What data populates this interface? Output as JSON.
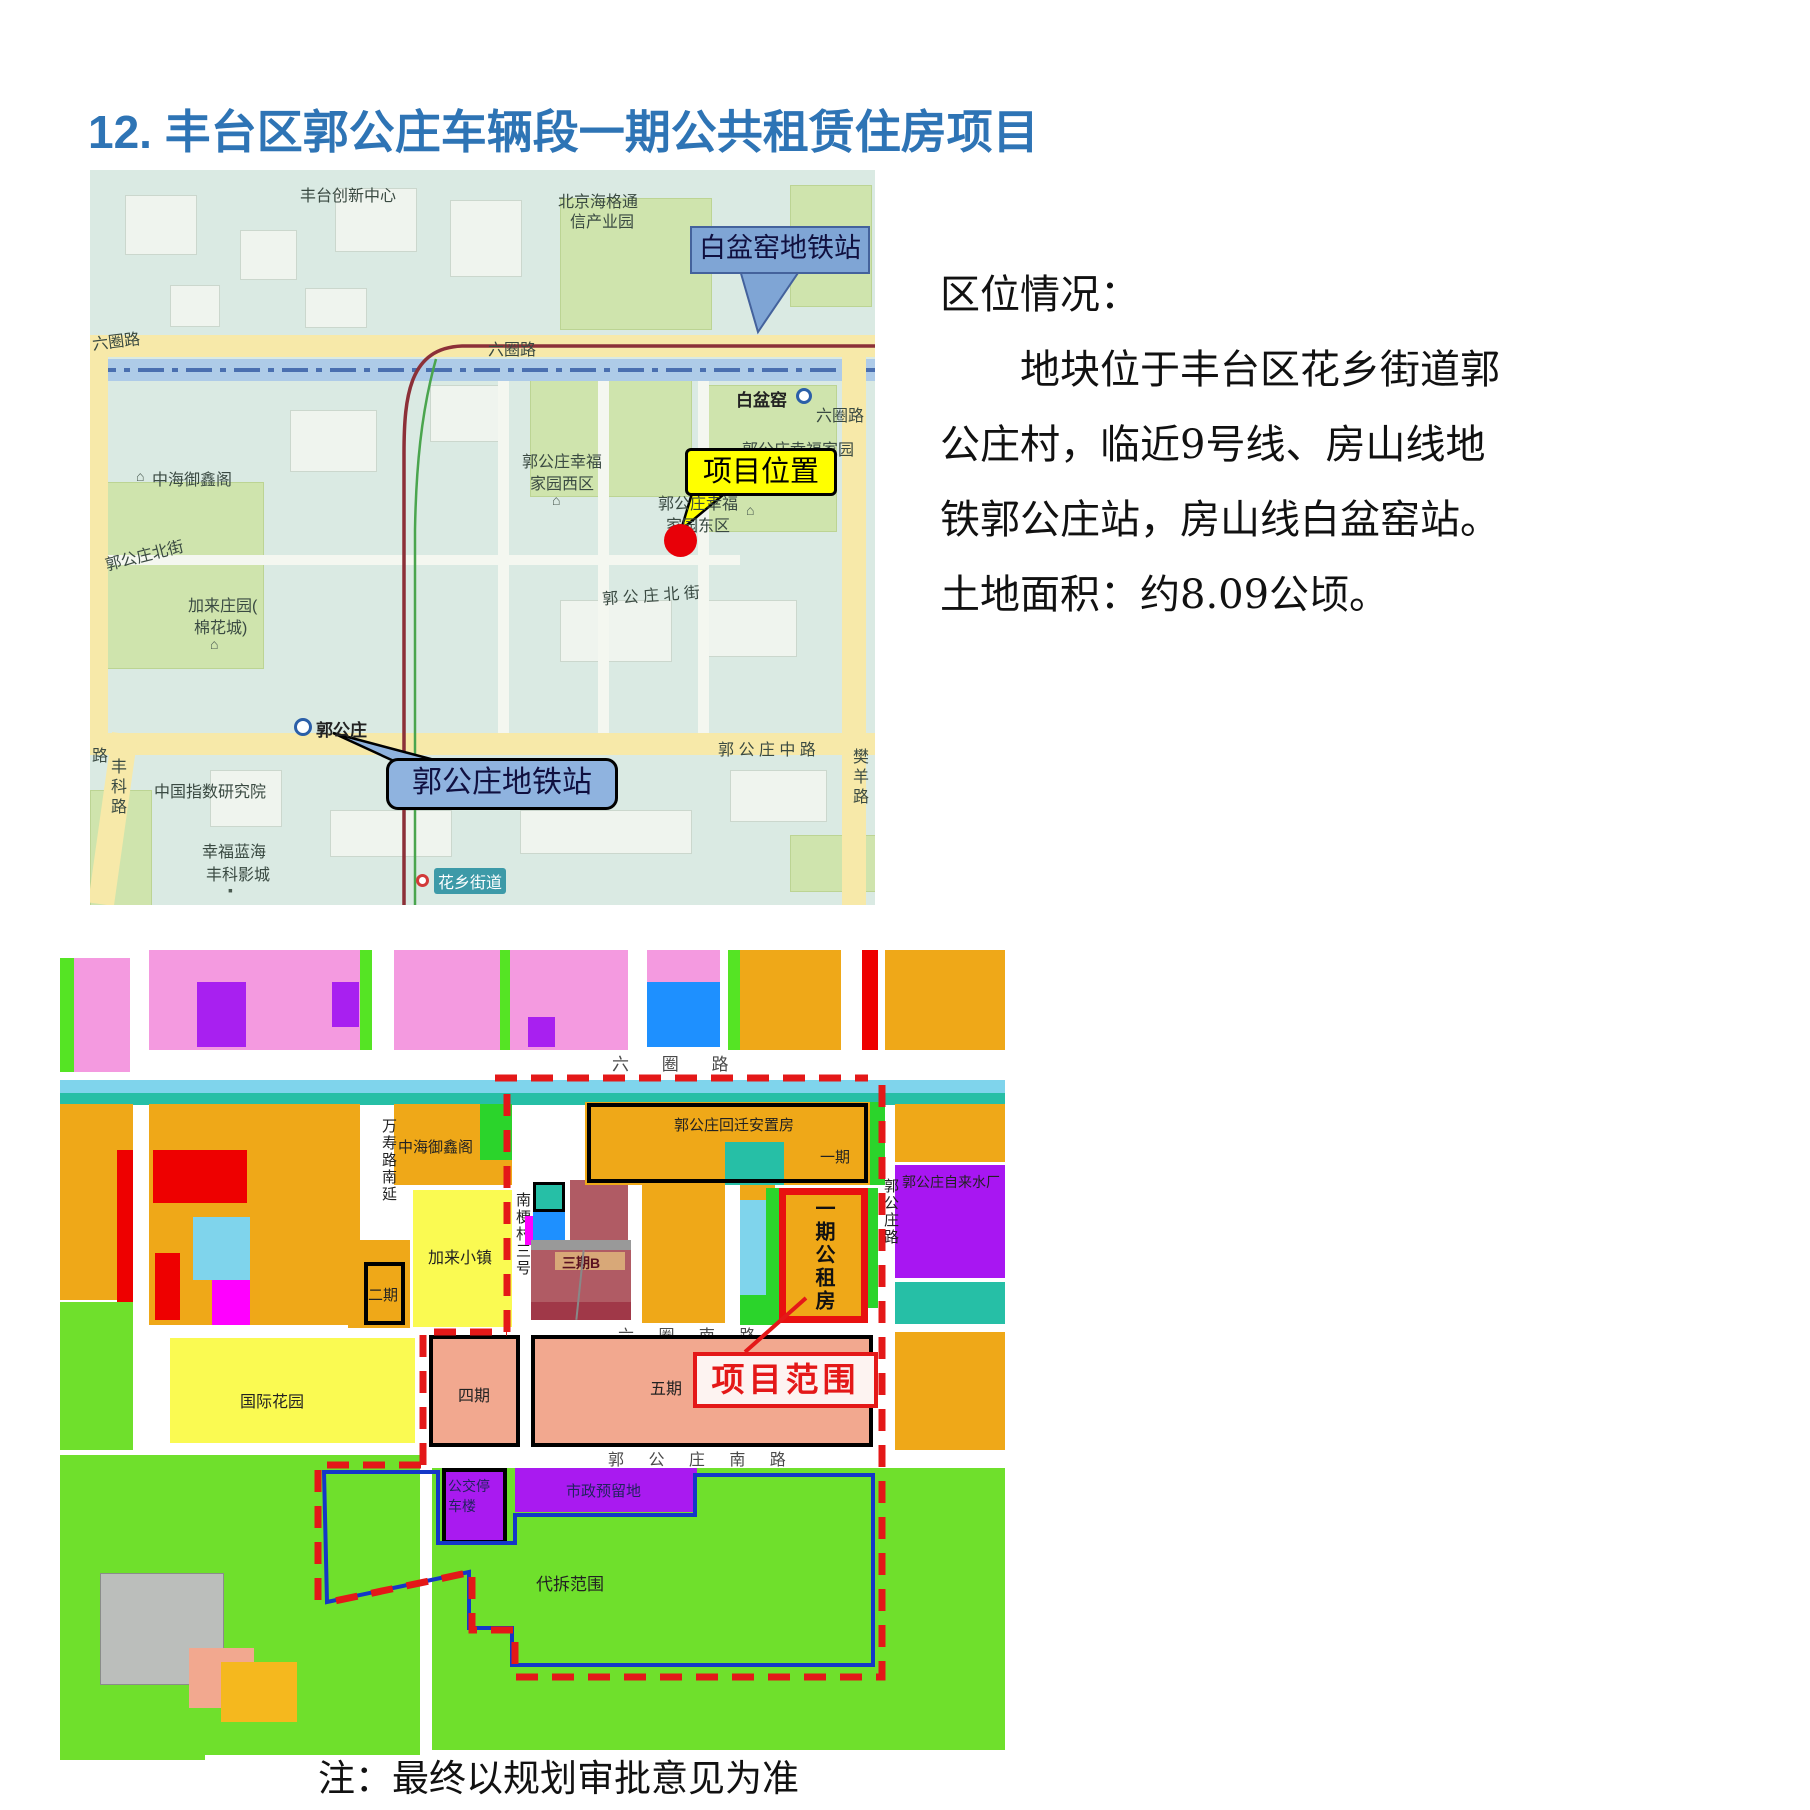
{
  "page": {
    "title": "12. 丰台区郭公庄车辆段一期公共租赁住房项目",
    "note": "注：最终以规划审批意见为准"
  },
  "info": {
    "heading": "区位情况：",
    "lines": [
      "地块位于丰台区花乡街道郭",
      "公庄村，临近9号线、房山线地",
      "铁郭公庄站，房山线白盆窑站。",
      "土地面积：约8.09公顷。"
    ]
  },
  "colors": {
    "title_blue": "#2E74B5",
    "callout_yellow": "#FFFF00",
    "callout_blue": "#7FA5D5",
    "boundary_red": "#E41818",
    "boundary_blue": "#1437C8",
    "marker_red": "#E80008"
  },
  "street_map": {
    "callouts": {
      "baipenyao": "白盆窑地铁站",
      "project_location": "项目位置",
      "guogongzhuang": "郭公庄地铁站"
    },
    "stations": {
      "baipenyao": "白盆窑",
      "guogongzhuang": "郭公庄"
    },
    "roads": {
      "liuquan_left": "六圈路",
      "liuquan_mid": "六圈路",
      "liuquan_right": "六圈路",
      "ggz_north_west": "郭公庄北街",
      "ggz_north_east": "郭 公 庄 北 街",
      "ggz_middle": "郭 公 庄 中 路",
      "fengke": "丰科路",
      "fanyang": "樊羊路",
      "lu": "路"
    },
    "places": {
      "fengtai_innovation": "丰台创新中心",
      "haige_1": "北京海格通",
      "haige_2": "信产业园",
      "yicheng": "亿城天筑",
      "zhonghai": "中海御鑫阁",
      "xingfu_west_1": "郭公庄幸福",
      "xingfu_west_2": "家园西区",
      "xingfu_main": "郭公庄幸福家园",
      "xingfu_east_1": "郭公庄幸福",
      "xingfu_east_2": "家园东区",
      "jialai_1": "加来庄园(",
      "jialai_2": "棉花城)",
      "index_institute": "中国指数研究院",
      "cinema_1": "幸福蓝海",
      "cinema_2": "丰科影城",
      "huaxiang": "花乡街道"
    }
  },
  "plan_map": {
    "callout": "项目范围",
    "parcels": {
      "huiqian": "郭公庄回迁安置房",
      "yiqi": "一期",
      "yiqi_gongzufang": "一期公租房",
      "erqi": "二期",
      "sanqi_b": "三期B",
      "siqi": "四期",
      "wuqi": "五期",
      "jialai_town": "加来小镇",
      "guoji_garden": "国际花园",
      "zhonghai": "中海御鑫阁",
      "water_plant": "郭公庄自来水厂",
      "bus_tower": "公交停车楼",
      "shizheng": "市政预留地",
      "daichai": "代拆范围"
    },
    "roads": {
      "liuquan": "六 圈 路",
      "liuquan_south": "六 圈 南 路",
      "ggz_south": "郭 公 庄 南 路",
      "wanshou": "万寿路南延",
      "nangeng": "南梗村三号",
      "ggz_road": "郭公庄路"
    }
  }
}
